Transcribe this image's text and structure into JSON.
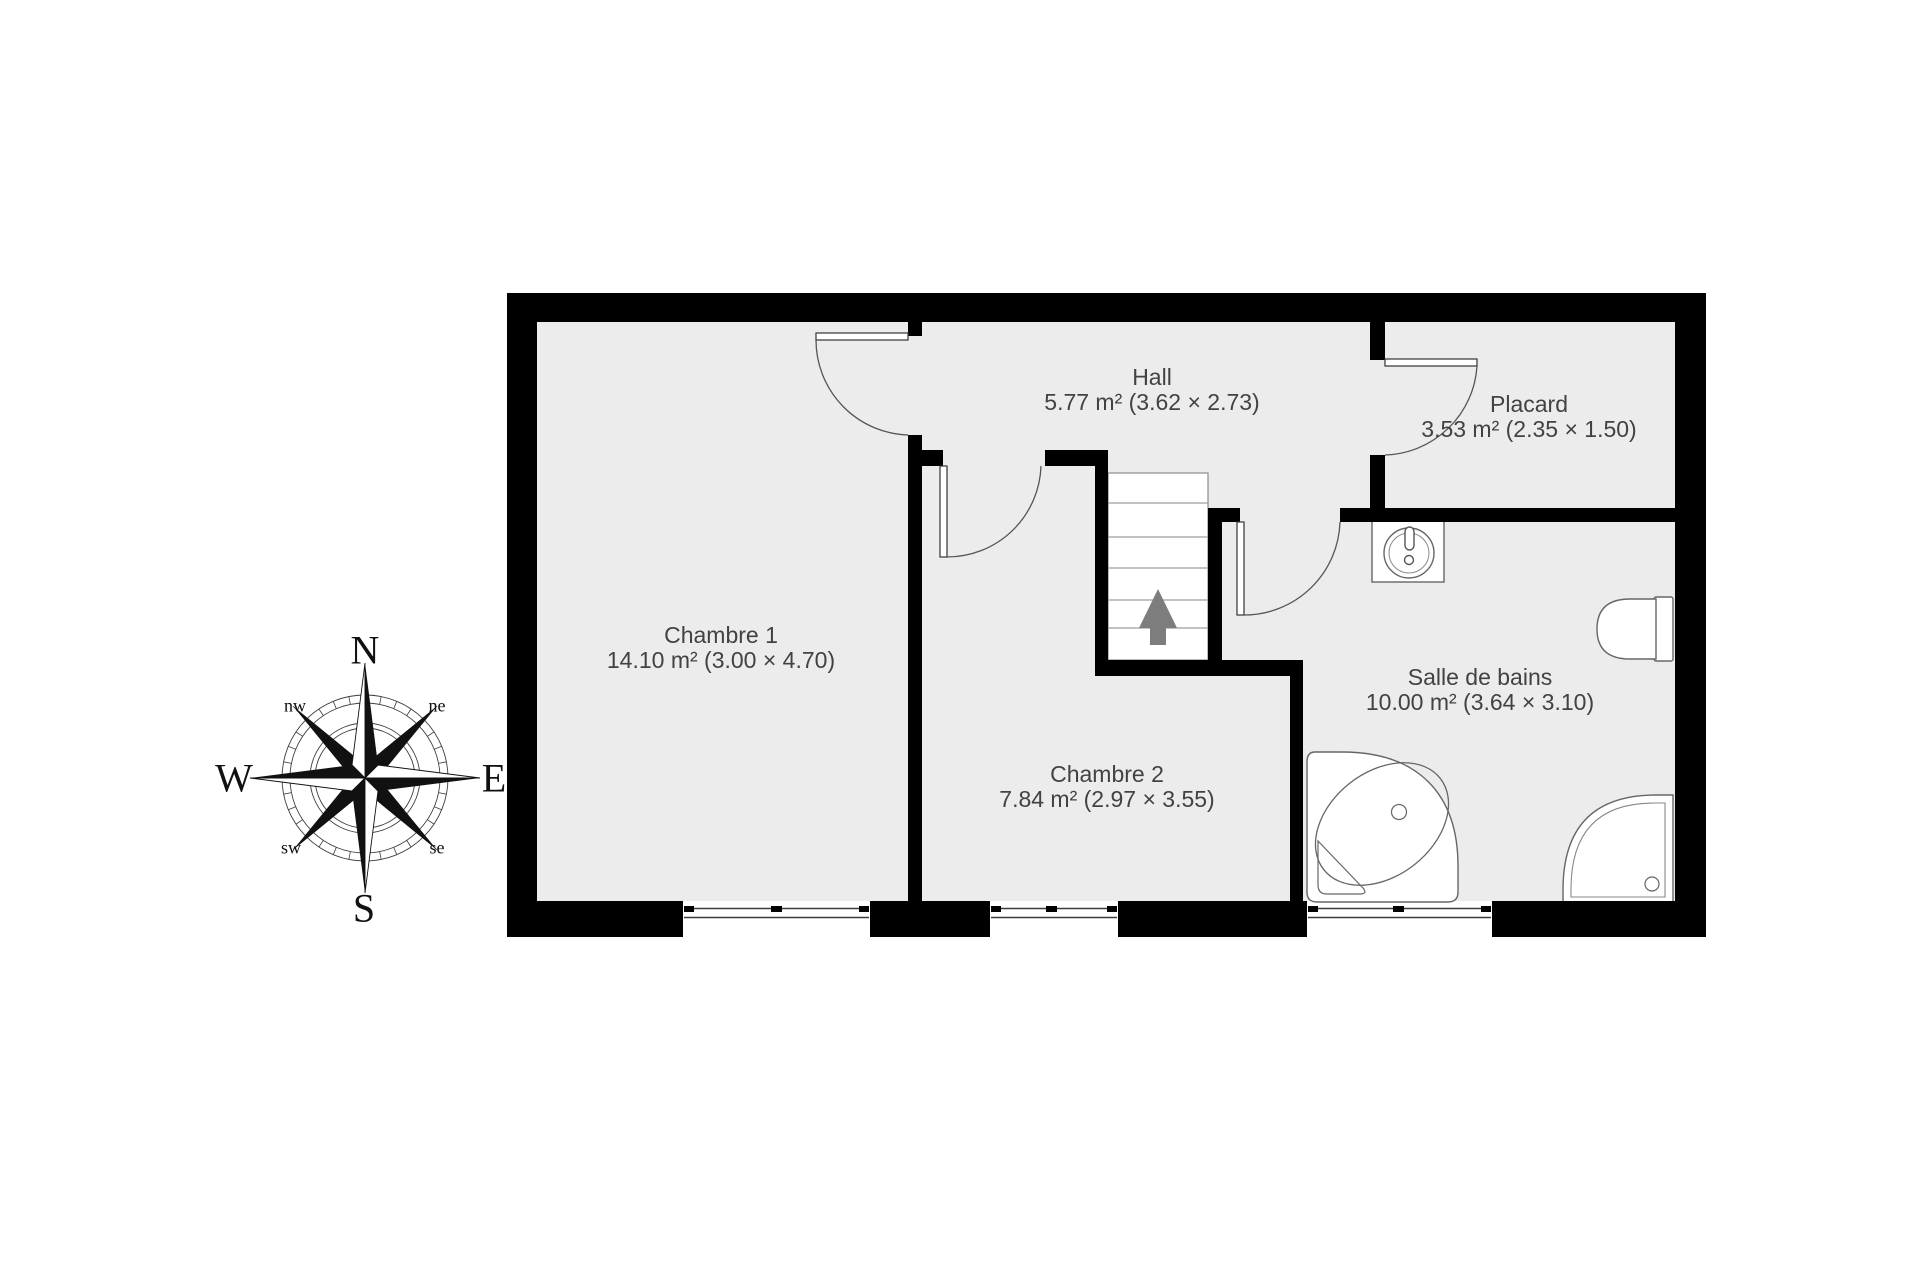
{
  "rooms": [
    {
      "name": "Chambre 1",
      "area": "14.10 m² (3.00 × 4.70)"
    },
    {
      "name": "Hall",
      "area": "5.77 m² (3.62 × 2.73)"
    },
    {
      "name": "Placard",
      "area": "3.53 m² (2.35 × 1.50)"
    },
    {
      "name": "Chambre 2",
      "area": "7.84 m² (2.97 × 3.55)"
    },
    {
      "name": "Salle de bains",
      "area": "10.00 m² (3.64 × 3.10)"
    }
  ],
  "compass": {
    "north": "N",
    "south": "S",
    "east": "E",
    "west": "W",
    "northwest": "nw",
    "northeast": "ne",
    "southwest": "sw",
    "southeast": "se"
  },
  "colors": {
    "floor": "#ececec",
    "wall": "#000000",
    "label_text": "#424242",
    "fixture_line": "#666666",
    "stairs_arrow": "#7d7d7d"
  }
}
